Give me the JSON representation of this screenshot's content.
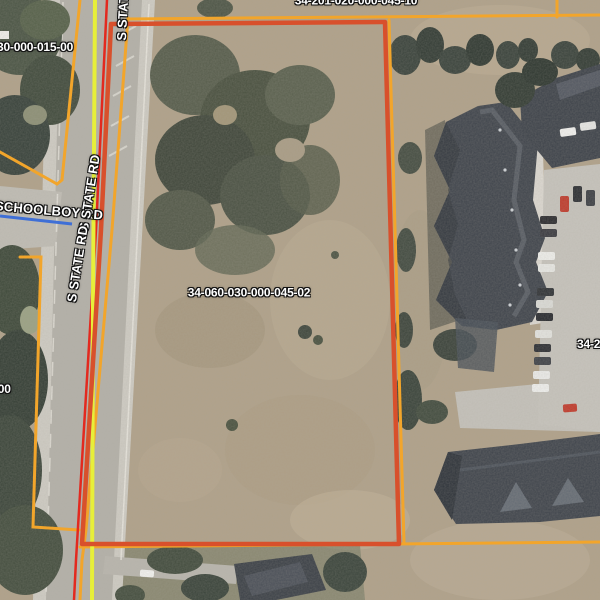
{
  "map": {
    "view": {
      "width": 600,
      "height": 600,
      "kind": "aerial-parcel-viewer"
    },
    "labels": {
      "parcel_subject": "34-060-030-000-045-02",
      "parcel_top_left": "30-000-015-00",
      "parcel_top_partial": "34-201-020-000-045-10",
      "parcel_right_partial": "34-2",
      "parcel_left_partial": "-00",
      "road_schoolboy": "SCHOOLBOY RD",
      "road_state_top": "S STATE RD",
      "road_state_upper": "S STATE RD",
      "road_state_lower": "S STATE RD"
    },
    "colors": {
      "parcel_line": "#f2a52b",
      "subject_highlight": "#d8502c",
      "state_road_line": "#e3291f",
      "road_centerline": "#e7ef3a",
      "schoolboy_centerline": "#3f6fd6",
      "label_text": "#ffffff",
      "label_halo": "#111111"
    }
  }
}
